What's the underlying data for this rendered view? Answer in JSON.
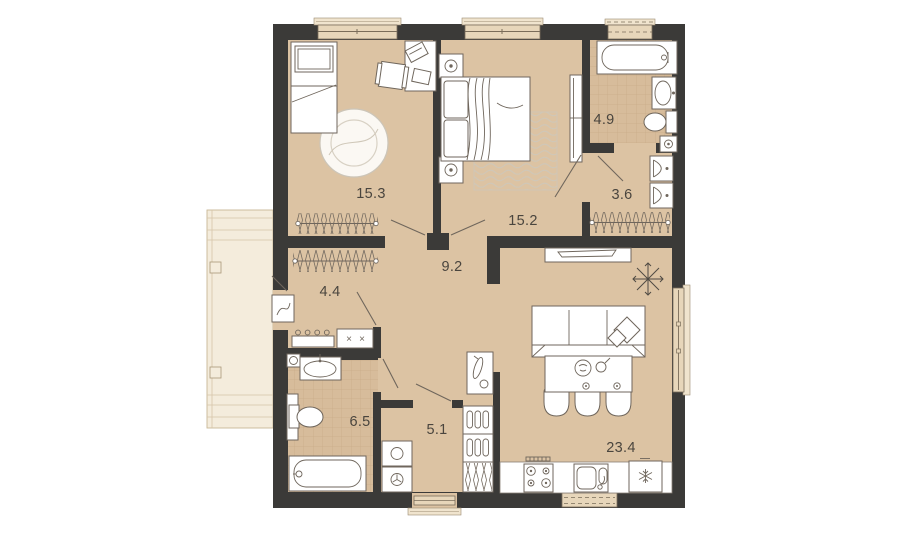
{
  "title": "apartment-floor-plan",
  "colors": {
    "wall": "#3b3a38",
    "floor": "#dcc3a3",
    "tile_floor": "#d7bc9b",
    "balcony_floor": "#f4ecdc",
    "furniture_outline": "#6f665c",
    "window_fill": "#e7d6ba",
    "label_text": "#4a453e"
  },
  "rooms": [
    {
      "name": "bedroom-1",
      "area": "15.3"
    },
    {
      "name": "bedroom-2",
      "area": "15.2"
    },
    {
      "name": "bathroom-main",
      "area": "4.9"
    },
    {
      "name": "wardrobe-room",
      "area": "3.6"
    },
    {
      "name": "hallway",
      "area": "9.2"
    },
    {
      "name": "entry-hall",
      "area": "4.4"
    },
    {
      "name": "bathroom-second",
      "area": "6.5"
    },
    {
      "name": "corridor",
      "area": "5.1"
    },
    {
      "name": "living-kitchen",
      "area": "23.4"
    }
  ],
  "marks": {
    "cross": "×"
  }
}
